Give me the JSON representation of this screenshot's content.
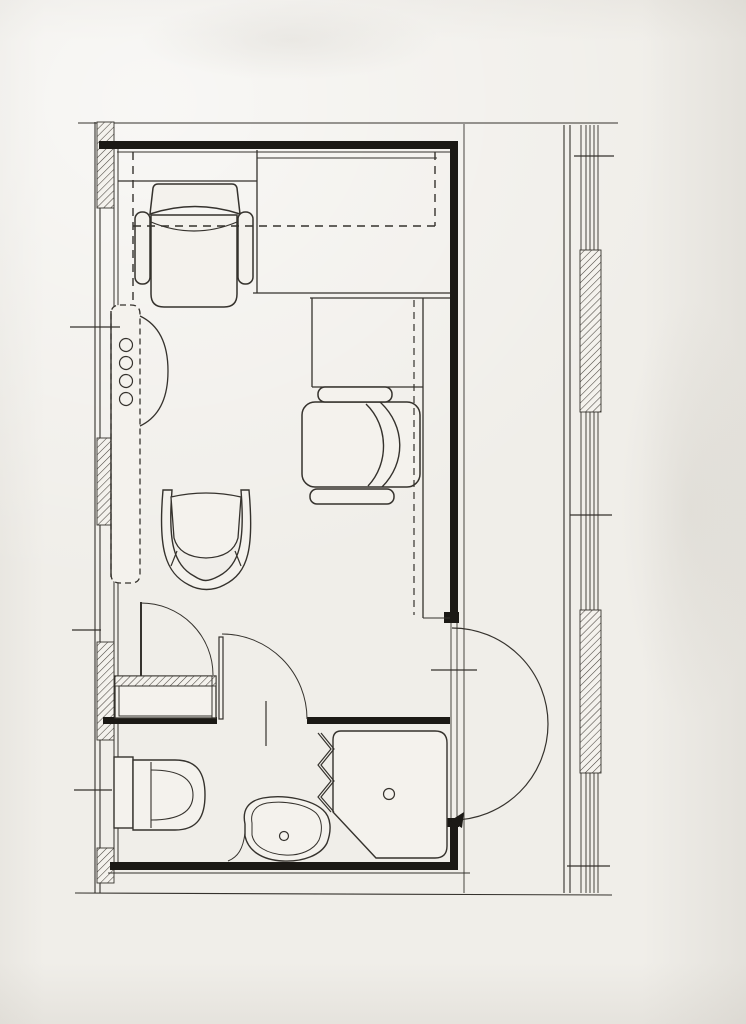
{
  "document": {
    "kind": "scanned architectural floor plan",
    "subject": "single hotel-room unit plan with fold-down bed alcove, wardrobe, desk with armchairs, entry door and bathroom (toilet, washbasin, corner shower)",
    "visible_text": []
  },
  "palette": {
    "paper": "#f0eee9",
    "white": "#f4f2ed",
    "ink": "#35322d",
    "wall": "#1b1915",
    "hatch": "#4a453f"
  },
  "canvas": {
    "width": 746,
    "height": 1024
  },
  "elements": [
    {
      "n": "top-boundary-line",
      "k": "line",
      "x1": 78,
      "y1": 123,
      "x2": 618,
      "y2": 123,
      "w": 1.1
    },
    {
      "n": "left-facade-outer-line",
      "k": "line",
      "x1": 95,
      "y1": 122,
      "x2": 95,
      "y2": 893,
      "w": 1.1
    },
    {
      "n": "left-facade-outer-line-2",
      "k": "line",
      "x1": 100,
      "y1": 122,
      "x2": 100,
      "y2": 893,
      "w": 1.1
    },
    {
      "n": "left-wall-inner-face-line",
      "k": "line",
      "x1": 114,
      "y1": 147,
      "x2": 114,
      "y2": 862,
      "w": 1
    },
    {
      "n": "left-wall-inner-face-line-2",
      "k": "line",
      "x1": 118,
      "y1": 147,
      "x2": 118,
      "y2": 862,
      "w": 1
    },
    {
      "n": "corridor-wall-line",
      "k": "line",
      "x1": 564,
      "y1": 125,
      "x2": 564,
      "y2": 893,
      "w": 1.1
    },
    {
      "n": "corridor-wall-line-2",
      "k": "line",
      "x1": 570,
      "y1": 125,
      "x2": 570,
      "y2": 893,
      "w": 1.1
    },
    {
      "n": "facade-glazing-line-1",
      "k": "line",
      "x1": 581,
      "y1": 125,
      "x2": 581,
      "y2": 893,
      "w": 0.9
    },
    {
      "n": "facade-glazing-line-2",
      "k": "line",
      "x1": 586,
      "y1": 125,
      "x2": 586,
      "y2": 893,
      "w": 0.9
    },
    {
      "n": "facade-glazing-line-3",
      "k": "line",
      "x1": 590,
      "y1": 125,
      "x2": 590,
      "y2": 893,
      "w": 0.9
    },
    {
      "n": "facade-glazing-line-4",
      "k": "line",
      "x1": 594,
      "y1": 125,
      "x2": 594,
      "y2": 893,
      "w": 0.9
    },
    {
      "n": "facade-glazing-line-5",
      "k": "line",
      "x1": 598,
      "y1": 125,
      "x2": 598,
      "y2": 893,
      "w": 0.9
    },
    {
      "n": "left-facade-pier-1",
      "k": "rect",
      "x": 97,
      "y": 122,
      "w": 17,
      "h": 86,
      "f": "H"
    },
    {
      "n": "left-facade-pier-2",
      "k": "rect",
      "x": 97,
      "y": 438,
      "w": 17,
      "h": 87,
      "f": "H"
    },
    {
      "n": "left-facade-pier-3",
      "k": "rect",
      "x": 97,
      "y": 642,
      "w": 17,
      "h": 98,
      "f": "H"
    },
    {
      "n": "left-facade-pier-4",
      "k": "rect",
      "x": 97,
      "y": 848,
      "w": 17,
      "h": 35,
      "f": "H"
    },
    {
      "n": "right-facade-pier-1",
      "k": "rect",
      "x": 580,
      "y": 250,
      "w": 21,
      "h": 162,
      "f": "H"
    },
    {
      "n": "right-facade-pier-2",
      "k": "rect",
      "x": 580,
      "y": 610,
      "w": 21,
      "h": 163,
      "f": "H"
    },
    {
      "n": "bottom-boundary-line",
      "k": "line",
      "x1": 75,
      "y1": 893,
      "x2": 612,
      "y2": 895,
      "w": 1.1
    },
    {
      "n": "top-wall",
      "k": "rect",
      "x": 99,
      "y": 141,
      "w": 359,
      "h": 8,
      "f": "K"
    },
    {
      "n": "top-wall-inner-face-line",
      "k": "line",
      "x1": 117,
      "y1": 152,
      "x2": 450,
      "y2": 152,
      "w": 1.1
    },
    {
      "n": "right-wall-upper",
      "k": "rect",
      "x": 450,
      "y": 141,
      "w": 8,
      "h": 482,
      "f": "K"
    },
    {
      "n": "right-wall-outer-face-line",
      "k": "line",
      "x1": 464,
      "y1": 124,
      "x2": 464,
      "y2": 893,
      "w": 0.9
    },
    {
      "n": "entry-opening-line-a",
      "k": "line",
      "x1": 451,
      "y1": 623,
      "x2": 451,
      "y2": 820,
      "w": 0.9
    },
    {
      "n": "entry-opening-line-b",
      "k": "line",
      "x1": 457,
      "y1": 623,
      "x2": 457,
      "y2": 820,
      "w": 0.9
    },
    {
      "n": "entry-jamb-upper",
      "k": "rect",
      "x": 444,
      "y": 612,
      "w": 15,
      "h": 11,
      "f": "K"
    },
    {
      "n": "entry-jamb-lower",
      "k": "rect",
      "x": 444,
      "y": 818,
      "w": 15,
      "h": 9,
      "f": "K"
    },
    {
      "n": "right-wall-lower",
      "k": "rect",
      "x": 450,
      "y": 820,
      "w": 8,
      "h": 50,
      "f": "K"
    },
    {
      "n": "bottom-wall",
      "k": "rect",
      "x": 110,
      "y": 862,
      "w": 348,
      "h": 8,
      "f": "K"
    },
    {
      "n": "bottom-wall-outer-line",
      "k": "line",
      "x1": 108,
      "y1": 873,
      "x2": 470,
      "y2": 873,
      "w": 0.9
    },
    {
      "n": "bathroom-wall-left",
      "k": "rect",
      "x": 103,
      "y": 717,
      "w": 114,
      "h": 7,
      "f": "K"
    },
    {
      "n": "bathroom-wall-right",
      "k": "rect",
      "x": 307,
      "y": 717,
      "w": 143,
      "h": 7,
      "f": "K"
    },
    {
      "n": "headboard-shelf-line",
      "k": "line",
      "x1": 118,
      "y1": 181,
      "x2": 257,
      "y2": 181,
      "w": 1.3
    },
    {
      "n": "headboard-shelf-side-line",
      "k": "line",
      "x1": 257,
      "y1": 150,
      "x2": 257,
      "y2": 293,
      "w": 1.3
    },
    {
      "n": "foldbed-cabinet-line",
      "k": "line",
      "x1": 257,
      "y1": 158,
      "x2": 437,
      "y2": 158,
      "w": 1.1
    },
    {
      "n": "alcove-edge-line",
      "k": "line",
      "x1": 253,
      "y1": 293,
      "x2": 450,
      "y2": 293,
      "w": 1.3
    },
    {
      "n": "desk-top-line",
      "k": "line",
      "x1": 310,
      "y1": 298,
      "x2": 450,
      "y2": 298,
      "w": 1.3
    },
    {
      "n": "desk-side-line",
      "k": "line",
      "x1": 312,
      "y1": 298,
      "x2": 312,
      "y2": 387,
      "w": 1.3
    },
    {
      "n": "desk-bottom-line",
      "k": "line",
      "x1": 312,
      "y1": 387,
      "x2": 423,
      "y2": 387,
      "w": 1.3
    },
    {
      "n": "counter-front-line",
      "k": "line",
      "x1": 423,
      "y1": 298,
      "x2": 423,
      "y2": 618,
      "w": 1.3
    },
    {
      "n": "counter-end-line",
      "k": "line",
      "x1": 423,
      "y1": 618,
      "x2": 450,
      "y2": 618,
      "w": 1
    },
    {
      "n": "armchair-top-back",
      "k": "path",
      "d": "M150,214 L153,188 Q154,184 158,184 L232,184 Q236,184 237,188 L240,214 Q195,199 150,214 Z",
      "f": "W",
      "w": 1.5
    },
    {
      "n": "armchair-top-seat",
      "k": "path",
      "d": "M151,215 L237,215 L237,294 Q237,307 224,307 L164,307 Q151,307 151,294 Z",
      "f": "W",
      "w": 1.5
    },
    {
      "n": "armchair-top-cushion-line",
      "k": "path",
      "d": "M151,222 Q194,240 237,222",
      "f": "N",
      "w": 1.2
    },
    {
      "n": "armchair-top-armrest-left",
      "k": "rect",
      "x": 135,
      "y": 212,
      "w": 15,
      "h": 72,
      "rx": 7,
      "f": "W",
      "sw": 1.5
    },
    {
      "n": "armchair-top-armrest-right",
      "k": "rect",
      "x": 238,
      "y": 212,
      "w": 15,
      "h": 72,
      "rx": 7,
      "f": "W",
      "sw": 1.5
    },
    {
      "n": "armchair-desk-body",
      "k": "rect",
      "x": 302,
      "y": 402,
      "w": 118,
      "h": 85,
      "rx": 13,
      "f": "W",
      "sw": 1.5
    },
    {
      "n": "armchair-desk-back-line",
      "k": "path",
      "d": "M366,404 C389,426 389,464 368,486",
      "f": "N",
      "w": 1.4
    },
    {
      "n": "armchair-desk-back-line-2",
      "k": "path",
      "d": "M380,402 C406,426 406,463 382,487",
      "f": "N",
      "w": 1.4
    },
    {
      "n": "armchair-desk-armrest-top",
      "k": "rect",
      "x": 318,
      "y": 387,
      "w": 74,
      "h": 15,
      "rx": 7,
      "f": "W",
      "sw": 1.5
    },
    {
      "n": "armchair-desk-armrest-bottom",
      "k": "rect",
      "x": 310,
      "y": 489,
      "w": 84,
      "h": 15,
      "rx": 7,
      "f": "W",
      "sw": 1.5
    },
    {
      "n": "desk-overhead-dashed-line",
      "k": "line",
      "x1": 414,
      "y1": 300,
      "x2": 414,
      "y2": 615,
      "w": 1.2,
      "da": "7 5"
    },
    {
      "n": "desk-chair-frame",
      "k": "path",
      "d": "M163,490 C158,548 165,573 189,585 C200,591 213,591 224,585 C249,573 254,547 249,490 L241,490 C245,541 240,565 219,576 C208,582 203,582 194,576 C173,565 168,540 172,490 Z",
      "f": "W",
      "w": 1.4
    },
    {
      "n": "desk-chair-seat",
      "k": "path",
      "d": "M171,497 Q206,489 241,497 L238,538 Q233,557 206,558 Q179,557 174,538 Z",
      "f": "W",
      "w": 1.3
    },
    {
      "n": "desk-chair-spoke-left",
      "k": "line",
      "x1": 177,
      "y1": 551,
      "x2": 171,
      "y2": 566,
      "w": 1.2
    },
    {
      "n": "desk-chair-spoke-right",
      "k": "line",
      "x1": 235,
      "y1": 551,
      "x2": 241,
      "y2": 566,
      "w": 1.2
    },
    {
      "n": "foldbed-dashed-left",
      "k": "line",
      "x1": 133,
      "y1": 152,
      "x2": 133,
      "y2": 306,
      "w": 1.4,
      "da": "8 6"
    },
    {
      "n": "foldbed-dashed-bottom",
      "k": "line",
      "x1": 133,
      "y1": 226,
      "x2": 435,
      "y2": 226,
      "w": 1.4,
      "da": "8 6"
    },
    {
      "n": "foldbed-dashed-right",
      "k": "line",
      "x1": 435,
      "y1": 152,
      "x2": 435,
      "y2": 226,
      "w": 1.4,
      "da": "8 6"
    },
    {
      "n": "wardrobe-outline-dashed",
      "k": "path",
      "d": "M120,305 L131,305 Q140,305 140,314 L140,574 Q140,583 131,583 L120,583 Q111,583 111,574 L111,314 Q111,305 120,305 Z",
      "f": "W",
      "w": 1.3,
      "da": "6 4"
    },
    {
      "n": "wardrobe-front-edge-line",
      "k": "line",
      "x1": 111,
      "y1": 311,
      "x2": 111,
      "y2": 577,
      "w": 1.4
    },
    {
      "n": "wardrobe-swing-arc",
      "k": "path",
      "d": "M140,316 C161,326 168,347 168,371 C168,395 161,416 140,426",
      "f": "N",
      "w": 1.3
    },
    {
      "n": "wardrobe-knob-1",
      "k": "circle",
      "cx": 126,
      "cy": 345,
      "r": 6.5,
      "f": "W",
      "w": 1.2
    },
    {
      "n": "wardrobe-knob-2",
      "k": "circle",
      "cx": 126,
      "cy": 363,
      "r": 6.5,
      "f": "W",
      "w": 1.2
    },
    {
      "n": "wardrobe-knob-3",
      "k": "circle",
      "cx": 126,
      "cy": 381,
      "r": 6.5,
      "f": "W",
      "w": 1.2
    },
    {
      "n": "wardrobe-knob-4",
      "k": "circle",
      "cx": 126,
      "cy": 399,
      "r": 6.5,
      "f": "W",
      "w": 1.2
    },
    {
      "n": "closet-door-leaf",
      "k": "line",
      "x1": 141,
      "y1": 602,
      "x2": 141,
      "y2": 676,
      "w": 2
    },
    {
      "n": "closet-door-arc",
      "k": "path",
      "d": "M141,603 A72,72 0 0 1 213,675",
      "f": "N",
      "w": 1
    },
    {
      "n": "bathroom-door-leaf",
      "k": "rect",
      "x": 219,
      "y": 637,
      "w": 4,
      "h": 82,
      "f": "W",
      "sw": 1.2
    },
    {
      "n": "bathroom-door-arc",
      "k": "path",
      "d": "M222,634 A85,85 0 0 1 307,719",
      "f": "N",
      "w": 1
    },
    {
      "n": "entry-door-arc",
      "k": "path",
      "d": "M452,628 A96,96 0 0 1 452,820",
      "f": "N",
      "w": 1.2
    },
    {
      "n": "entry-door-arrow",
      "k": "polygon",
      "pts": "450,821 464,812 462,828",
      "f": "K"
    },
    {
      "n": "closet-box",
      "k": "rect",
      "x": 115,
      "y": 676,
      "w": 101,
      "h": 42,
      "f": "W",
      "sw": 1.3
    },
    {
      "n": "closet-shelf-hatch",
      "k": "rect",
      "x": 115,
      "y": 676,
      "w": 101,
      "h": 10,
      "f": "H"
    },
    {
      "n": "closet-inner-box",
      "k": "rect",
      "x": 119,
      "y": 686,
      "w": 93,
      "h": 30,
      "f": "N",
      "sw": 1
    },
    {
      "n": "closet-side-line",
      "k": "line",
      "x1": 212,
      "y1": 676,
      "x2": 212,
      "y2": 718,
      "w": 1
    },
    {
      "n": "toilet-tank",
      "k": "rect",
      "x": 114,
      "y": 757,
      "w": 19,
      "h": 71,
      "f": "W",
      "sw": 1.4
    },
    {
      "n": "toilet-bowl",
      "k": "path",
      "d": "M133,760 L175,760 C198,760 205,774 205,795 C205,816 198,830 175,830 L133,830 Z",
      "f": "W",
      "w": 1.4
    },
    {
      "n": "toilet-seat-line",
      "k": "line",
      "x1": 151,
      "y1": 762,
      "x2": 151,
      "y2": 828,
      "w": 1.1
    },
    {
      "n": "toilet-bowl-inner-line",
      "k": "path",
      "d": "M151,770 C182,770 193,780 193,795 C193,810 182,820 151,820",
      "f": "N",
      "w": 1.1
    },
    {
      "n": "washbasin-outer",
      "k": "path",
      "d": "M245,824 C242,810 248,801 263,798 C285,794 312,800 323,810 C331,817 332,830 327,843 C321,855 303,862 283,861 C261,860 248,850 245,836 Z",
      "f": "W",
      "w": 1.4
    },
    {
      "n": "washbasin-inner",
      "k": "path",
      "d": "M252,823 C250,812 256,805 267,803 C286,800 307,805 316,813 C322,819 323,830 319,840 C314,850 300,856 285,855 C267,854 254,846 252,835 Z",
      "f": "N",
      "w": 1
    },
    {
      "n": "washbasin-faucet",
      "k": "circle",
      "cx": 284,
      "cy": 836,
      "r": 4.5,
      "f": "N",
      "w": 1.2
    },
    {
      "n": "washbasin-wall-curve",
      "k": "path",
      "d": "M245,833 C243,849 238,857 228,861",
      "f": "N",
      "w": 1
    },
    {
      "n": "shower-pan",
      "k": "path",
      "d": "M341,731 L435,731 Q447,731 447,743 L447,846 Q447,858 435,858 L376,858 L333,812 L333,740 Q333,731 341,731 Z",
      "f": "W",
      "w": 1.4
    },
    {
      "n": "shower-drain",
      "k": "circle",
      "cx": 389,
      "cy": 794,
      "r": 5.5,
      "f": "N",
      "w": 1.2
    },
    {
      "n": "shower-folding-screen",
      "k": "polyline",
      "pts": "318,733 331,749 318,765 331,781 318,797 331,812",
      "w": 1.2
    },
    {
      "n": "shower-folding-screen-2",
      "k": "polyline",
      "pts": "321,733 334,749 321,765 334,781 321,797 334,812",
      "w": 1.2
    },
    {
      "n": "tick-left-upper",
      "k": "line",
      "x1": 70,
      "y1": 327,
      "x2": 120,
      "y2": 327,
      "w": 1.2
    },
    {
      "n": "tick-left-middle",
      "k": "line",
      "x1": 72,
      "y1": 630,
      "x2": 101,
      "y2": 630,
      "w": 1.2
    },
    {
      "n": "tick-left-lower",
      "k": "line",
      "x1": 74,
      "y1": 790,
      "x2": 112,
      "y2": 790,
      "w": 1.2
    },
    {
      "n": "tick-corridor-upper",
      "k": "line",
      "x1": 574,
      "y1": 156,
      "x2": 614,
      "y2": 156,
      "w": 1.3
    },
    {
      "n": "tick-corridor-middle",
      "k": "line",
      "x1": 570,
      "y1": 515,
      "x2": 612,
      "y2": 515,
      "w": 1.3
    },
    {
      "n": "tick-corridor-lower",
      "k": "line",
      "x1": 567,
      "y1": 866,
      "x2": 610,
      "y2": 866,
      "w": 1.3
    },
    {
      "n": "tick-entry",
      "k": "line",
      "x1": 431,
      "y1": 670,
      "x2": 477,
      "y2": 670,
      "w": 1.2
    },
    {
      "n": "tick-bathroom-door",
      "k": "line",
      "x1": 266,
      "y1": 701,
      "x2": 266,
      "y2": 746,
      "w": 1.2
    }
  ]
}
